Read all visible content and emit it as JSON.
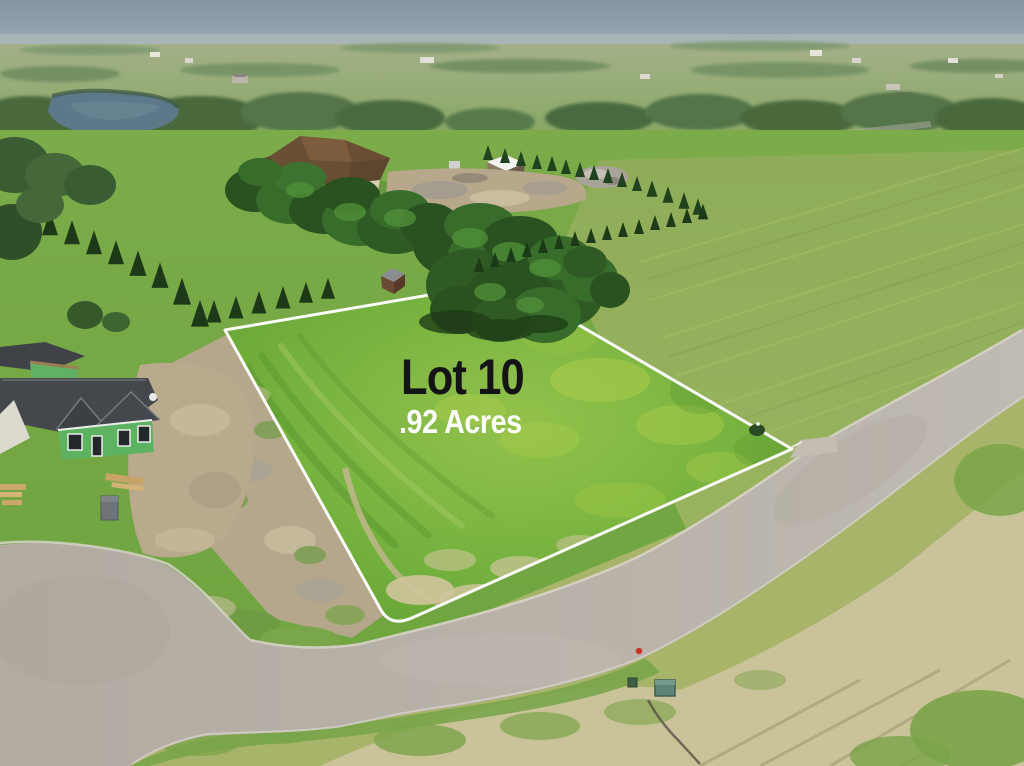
{
  "image": {
    "kind": "aerial-drone-real-estate-photo",
    "width_px": 1024,
    "height_px": 766
  },
  "overlay": {
    "lot_label": "Lot 10",
    "acreage_label": ".92 Acres",
    "lot_label_color": "#141414",
    "acreage_label_color": "#ffffff",
    "parcel_outline_color": "#ffffff"
  },
  "scene": {
    "subject": "vacant residential lot outlined in white beside a new paved street with cul-de-sac",
    "elements": [
      "hazy blue sky band",
      "distant farm fields and tree lines with scattered houses",
      "small pond at upper left",
      "large brown ranch house upper left",
      "white-roofed barn and dirt construction staging area",
      "small brown shed at top of lot",
      "dense green tree mass at top of lot",
      "rows of small evergreen trees marking lot boundaries",
      "white surveyed parcel outline",
      "new asphalt street curving from cul-de-sac to upper right",
      "house under construction with green sheathing at lower left",
      "dirt driveway, lumber piles and portable toilet",
      "straw-colored disturbed ground below road",
      "green utility boxes and red hydrant marker"
    ],
    "palette": {
      "sky": "#8a9aa9",
      "haze": "#b6c1ba",
      "distant_field": "#8aa36a",
      "mid_field": "#79a947",
      "parcel_grass": "#76b23e",
      "parcel_bright": "#9ac54e",
      "tree_dark": "#2a5120",
      "pine_dark": "#1c3a17",
      "road_gray": "#b7b1a8",
      "curb_light": "#d8d3c9",
      "dirt_tan": "#b5a78b",
      "straw": "#cdc49e",
      "house_roof": "#44474b",
      "house_green_wall": "#5db361",
      "brown_roof": "#6b4f35",
      "water": "#5d7888",
      "hydrant_red": "#cc3327"
    }
  }
}
